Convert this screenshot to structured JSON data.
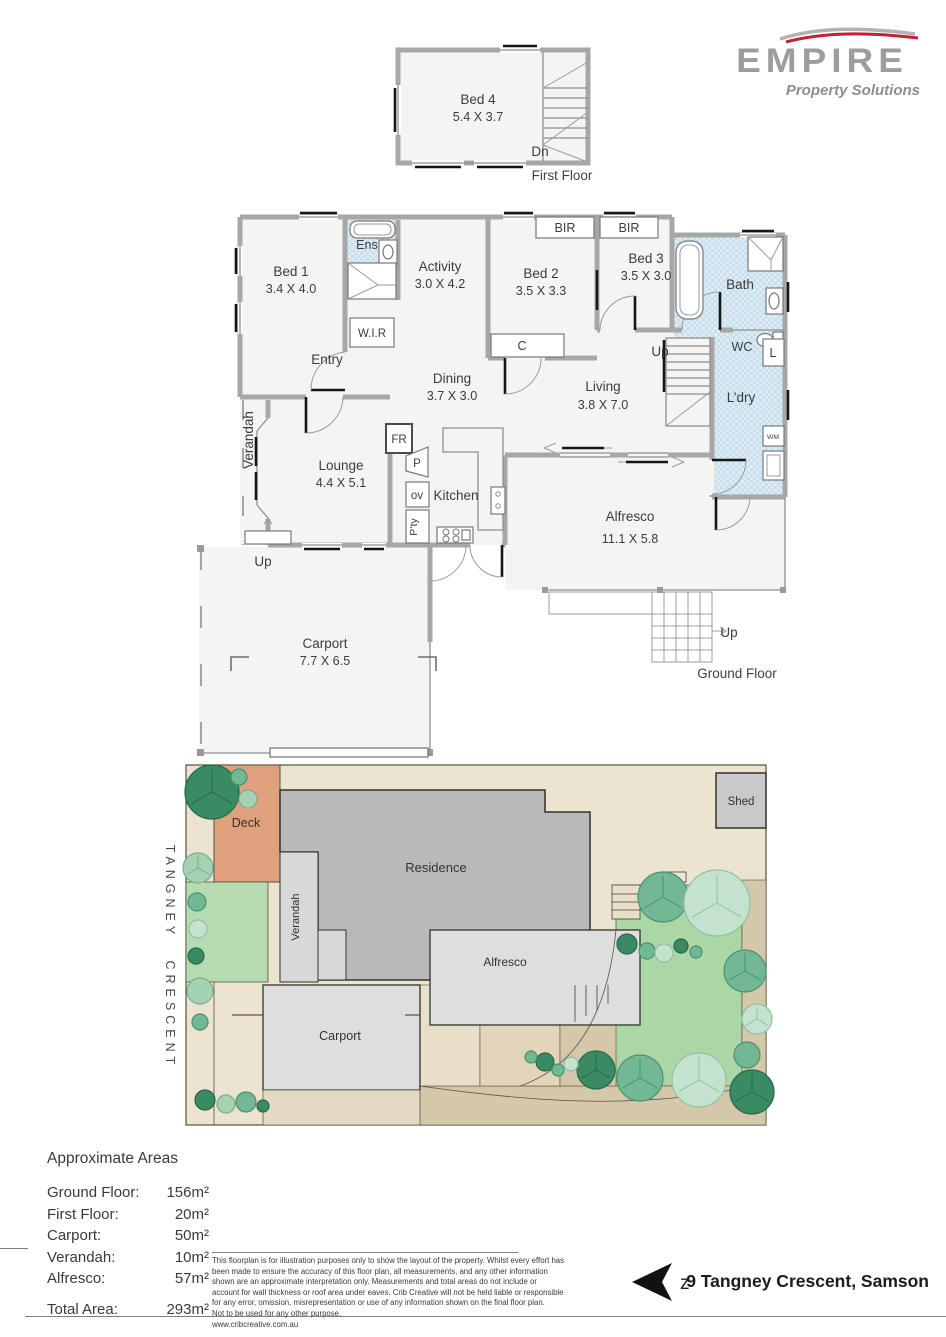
{
  "logo": {
    "brand": "EMPIRE",
    "tagline": "Property Solutions",
    "gray": "#9d9d9d",
    "red": "#c32032"
  },
  "first_floor": {
    "caption": "First Floor",
    "stair_label": "Dn",
    "rooms": {
      "bed4": {
        "name": "Bed 4",
        "dims": "5.4 X 3.7"
      }
    }
  },
  "ground_floor": {
    "caption": "Ground Floor",
    "rooms": {
      "bed1": {
        "name": "Bed 1",
        "dims": "3.4 X 4.0"
      },
      "ens": {
        "name": "Ens"
      },
      "wir": {
        "name": "W.I.R"
      },
      "activity": {
        "name": "Activity",
        "dims": "3.0 X 4.2"
      },
      "bed2": {
        "name": "Bed 2",
        "dims": "3.5 X 3.3"
      },
      "bir_left": {
        "name": "BIR"
      },
      "bir_right": {
        "name": "BIR"
      },
      "bed3": {
        "name": "Bed 3",
        "dims": "3.5 X 3.0"
      },
      "bath": {
        "name": "Bath"
      },
      "wc": {
        "name": "WC"
      },
      "cupboard": {
        "name": "C"
      },
      "linen": {
        "name": "L"
      },
      "laundry": {
        "name": "L’dry"
      },
      "wm": {
        "name": "WM"
      },
      "stairs_up": {
        "name": "Up"
      },
      "entry": {
        "name": "Entry"
      },
      "dining": {
        "name": "Dining",
        "dims": "3.7 X 3.0"
      },
      "living": {
        "name": "Living",
        "dims": "3.8 X 7.0"
      },
      "verandah": {
        "name": "Verandah"
      },
      "lounge": {
        "name": "Lounge",
        "dims": "4.4 X 5.1"
      },
      "fridge": {
        "name": "FR"
      },
      "pantry_small": {
        "name": "P"
      },
      "oven": {
        "name": "ov"
      },
      "kitchen": {
        "name": "Kitchen"
      },
      "pantry": {
        "name": "P’ty"
      },
      "alfresco": {
        "name": "Alfresco",
        "dims": "11.1 X 5.8"
      },
      "up_front": {
        "name": "Up"
      },
      "carport": {
        "name": "Carport",
        "dims": "7.7 X 6.5"
      },
      "up_rear": {
        "name": "Up"
      }
    }
  },
  "site_plan": {
    "street": "TANGNEY CRESCENT",
    "labels": {
      "deck": "Deck",
      "verandah": "Verandah",
      "residence": "Residence",
      "alfresco": "Alfresco",
      "carport": "Carport",
      "shed": "Shed"
    }
  },
  "areas": {
    "title": "Approximate Areas",
    "rows": [
      {
        "label": "Ground Floor:",
        "value": "156m²"
      },
      {
        "label": "First Floor:",
        "value": "20m²"
      },
      {
        "label": "Carport:",
        "value": "50m²"
      },
      {
        "label": "Verandah:",
        "value": "10m²"
      },
      {
        "label": "Alfresco:",
        "value": "57m²"
      }
    ],
    "total": {
      "label": "Total Area:",
      "value": "293m²"
    }
  },
  "footer": {
    "disclaimer_lines": [
      "This floorplan is for illustration purposes only to show the layout of the property. Whilst every effort has",
      "been made to ensure the accuracy of this floor plan, all measurements, and any other information",
      "shown are an approximate interpretation only. Measurements and total areas do not include or",
      "account for wall thickness or roof area under eaves. Crib Creative will not be held liable or responsible",
      "for any error, omission, misrepresentation or use of any information shown on the final floor plan.",
      "Not to be used for any other purpose.",
      "www.cribcreative.com.au"
    ],
    "compass_letter": "z",
    "address": "9 Tangney Crescent, Samson"
  }
}
